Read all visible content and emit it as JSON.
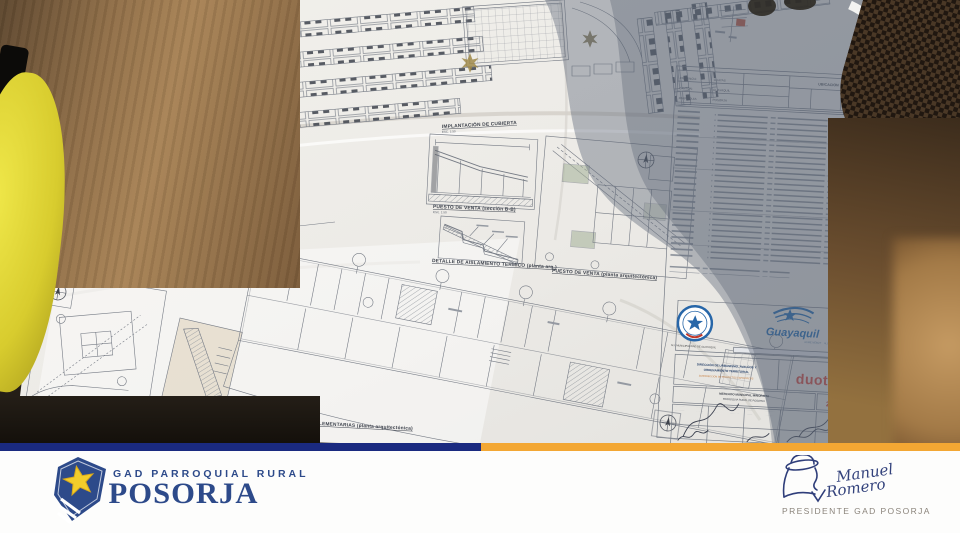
{
  "colors": {
    "stripe_navy": "#1a2a80",
    "stripe_gold": "#f3a733",
    "brand_navy": "#2d4a8a",
    "star_yellow": "#f3cd2b",
    "duot_red": "#d6453c",
    "city_blue": "#1a6ab5"
  },
  "photo": {
    "blueprint": {
      "captions": {
        "implantacion": "IMPLANTACIÓN DE CUBIERTA",
        "planta_general": "PLANTA ARQUITECTÓNICA GENERAL",
        "puesto_seccion": "PUESTO DE VENTA (sección B-B)",
        "detalle_termico": "DETALLE DE AISLAMIENTO TERMICO (planta arq.)",
        "puesto_planta": "PUESTO DE VENTA (planta arquitectónica)",
        "centro_acopio": "CENTRO DE ACOPIO DE DESECHOS (planta arquitectónica)",
        "recubrimiento": "RECUBRIMIENTO DE PISO (detalle)",
        "areas_complementarias": "BAJOS · ÁREAS COMPLEMENTARIAS (planta arquitectónica)",
        "via_label": "VÍA ACERA",
        "esc": "ESC. 1:50"
      },
      "title_block": {
        "ubicacion_header": "UBICACIÓN",
        "provincia_label": "PROVINCIA:",
        "canton_label": "CANTÓN:",
        "parroquia_label": "PARROQUIA:",
        "provincia_value": "GUAYAS",
        "canton_value": "GUAYAQUIL",
        "parroquia_value": "POSORJA",
        "seal_text": "M.I. MUNICIPALIDAD DE GUAYAQUIL",
        "city_brand": "Guayaquil",
        "mayor_name": "JAIME NEBOT",
        "mayor_title": "ALCALDE",
        "department_line1": "DIRECCIÓN DE URBANISMO, AVALÚOS Y",
        "department_line2": "ORDENAMIENTO TERRITORIAL",
        "department_sub": "SUBDIRECCIÓN DE PROYECTOS ESPECÍFICOS",
        "duot": "duot",
        "project_name": "MERCADO MUNICIPAL MINORISTA",
        "project_sub": "PARROQUIA RURAL DE POSORJA",
        "sheet_number": "2/5"
      }
    }
  },
  "footer": {
    "brand": {
      "top_label": "GAD PARROQUIAL RURAL",
      "name": "POSORJA"
    },
    "signature": {
      "name1": "Manuel",
      "name2": "Romero",
      "title": "PRESIDENTE GAD POSORJA"
    }
  }
}
